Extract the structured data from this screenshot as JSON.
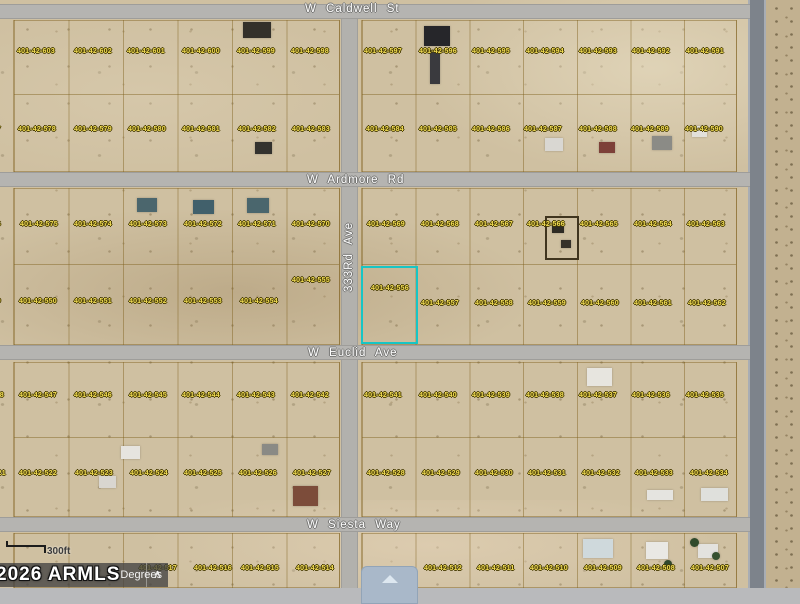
{
  "map": {
    "streets": {
      "caldwell": "W Caldwell St",
      "ardmore": "W Ardmore Rd",
      "euclid": "W Euclid Ave",
      "siesta": "W Siesta Way",
      "ave333": "333Rd Ave"
    },
    "highlight": {
      "parcel": "401-42-556",
      "color": "#17c5c5"
    },
    "plat_note": {
      "line1": "PHOEN",
      "line2": "VALLEY W",
      "line3": "MCR: 13"
    },
    "scale": {
      "label": "300ft"
    },
    "toolbar": {
      "degrees_label": "Degrees",
      "collapse_glyph": "∧"
    },
    "watermark": "2026 ARMLS",
    "label_color": "#f2dd55",
    "parcel_labels": [
      [
        "401-42-603",
        17,
        48
      ],
      [
        "401-42-602",
        74,
        48
      ],
      [
        "401-42-601",
        127,
        48
      ],
      [
        "401-42-600",
        182,
        48
      ],
      [
        "401-42-599",
        237,
        48
      ],
      [
        "401-42-598",
        291,
        48
      ],
      [
        "401-42-597",
        364,
        48
      ],
      [
        "401-42-596",
        419,
        48
      ],
      [
        "401-42-595",
        472,
        48
      ],
      [
        "401-42-594",
        526,
        48
      ],
      [
        "401-42-593",
        579,
        48
      ],
      [
        "401-42-592",
        632,
        48
      ],
      [
        "401-42-591",
        686,
        48
      ],
      [
        "401-42-577",
        -37,
        126
      ],
      [
        "401-42-578",
        18,
        126
      ],
      [
        "401-42-579",
        74,
        126
      ],
      [
        "401-42-580",
        128,
        126
      ],
      [
        "401-42-581",
        182,
        126
      ],
      [
        "401-42-582",
        238,
        126
      ],
      [
        "401-42-583",
        292,
        126
      ],
      [
        "401-42-584",
        366,
        126
      ],
      [
        "401-42-585",
        419,
        126
      ],
      [
        "401-42-586",
        472,
        126
      ],
      [
        "401-42-587",
        524,
        126
      ],
      [
        "401-42-588",
        579,
        126
      ],
      [
        "401-42-589",
        631,
        126
      ],
      [
        "401-42-590",
        685,
        126
      ],
      [
        "401-42-576",
        -37,
        221
      ],
      [
        "401-42-575",
        20,
        221
      ],
      [
        "401-42-574",
        74,
        221
      ],
      [
        "401-42-573",
        129,
        221
      ],
      [
        "401-42-572",
        184,
        221
      ],
      [
        "401-42-571",
        238,
        221
      ],
      [
        "401-42-570",
        292,
        221
      ],
      [
        "401-42-569",
        367,
        221
      ],
      [
        "401-42-568",
        421,
        221
      ],
      [
        "401-42-567",
        475,
        221
      ],
      [
        "401-42-566",
        527,
        221
      ],
      [
        "401-42-565",
        580,
        221
      ],
      [
        "401-42-564",
        634,
        221
      ],
      [
        "401-42-563",
        687,
        221
      ],
      [
        "401-42-549",
        -37,
        298
      ],
      [
        "401-42-550",
        19,
        298
      ],
      [
        "401-42-551",
        74,
        298
      ],
      [
        "401-42-552",
        129,
        298
      ],
      [
        "401-42-553",
        184,
        298
      ],
      [
        "401-42-554",
        240,
        298
      ],
      [
        "401-42-555",
        292,
        277
      ],
      [
        "401-42-557",
        421,
        300
      ],
      [
        "401-42-558",
        475,
        300
      ],
      [
        "401-42-559",
        528,
        300
      ],
      [
        "401-42-560",
        581,
        300
      ],
      [
        "401-42-561",
        634,
        300
      ],
      [
        "401-42-562",
        688,
        300
      ],
      [
        "401-42-548",
        -34,
        392
      ],
      [
        "401-42-547",
        19,
        392
      ],
      [
        "401-42-546",
        74,
        392
      ],
      [
        "401-42-545",
        129,
        392
      ],
      [
        "401-42-544",
        182,
        392
      ],
      [
        "401-42-543",
        237,
        392
      ],
      [
        "401-42-542",
        291,
        392
      ],
      [
        "401-42-541",
        364,
        392
      ],
      [
        "401-42-540",
        419,
        392
      ],
      [
        "401-42-539",
        472,
        392
      ],
      [
        "401-42-538",
        526,
        392
      ],
      [
        "401-42-537",
        579,
        392
      ],
      [
        "401-42-536",
        632,
        392
      ],
      [
        "401-42-535",
        686,
        392
      ],
      [
        "401-42-521",
        -32,
        470
      ],
      [
        "401-42-522",
        19,
        470
      ],
      [
        "401-42-523",
        75,
        470
      ],
      [
        "401-42-524",
        130,
        470
      ],
      [
        "401-42-525",
        184,
        470
      ],
      [
        "401-42-526",
        239,
        470
      ],
      [
        "401-42-527",
        293,
        470
      ],
      [
        "401-42-528",
        367,
        470
      ],
      [
        "401-42-529",
        422,
        470
      ],
      [
        "401-42-530",
        475,
        470
      ],
      [
        "401-42-531",
        528,
        470
      ],
      [
        "401-42-532",
        582,
        470
      ],
      [
        "401-42-533",
        635,
        470
      ],
      [
        "401-42-534",
        690,
        470
      ],
      [
        "401-42-517",
        139,
        565
      ],
      [
        "401-42-516",
        194,
        565
      ],
      [
        "401-42-515",
        241,
        565
      ],
      [
        "401-42-514",
        296,
        565
      ],
      [
        "401-42-512",
        424,
        565
      ],
      [
        "401-42-511",
        477,
        565
      ],
      [
        "401-42-510",
        530,
        565
      ],
      [
        "401-42-509",
        584,
        565
      ],
      [
        "401-42-508",
        637,
        565
      ],
      [
        "401-42-507",
        691,
        565
      ]
    ],
    "highlight_label": {
      "text": "401-42-556",
      "x": 371,
      "y": 285
    },
    "buildings": [
      {
        "x": 243,
        "y": 22,
        "w": 28,
        "h": 16,
        "c": "#33302a"
      },
      {
        "x": 424,
        "y": 26,
        "w": 26,
        "h": 20,
        "c": "#26262a"
      },
      {
        "x": 430,
        "y": 50,
        "w": 10,
        "h": 34,
        "c": "#3a3a3e"
      },
      {
        "x": 255,
        "y": 142,
        "w": 17,
        "h": 12,
        "c": "#33322e"
      },
      {
        "x": 545,
        "y": 138,
        "w": 18,
        "h": 13,
        "c": "#d9d7d2"
      },
      {
        "x": 599,
        "y": 142,
        "w": 16,
        "h": 11,
        "c": "#7d4038"
      },
      {
        "x": 652,
        "y": 136,
        "w": 20,
        "h": 14,
        "c": "#8b8b86"
      },
      {
        "x": 692,
        "y": 126,
        "w": 15,
        "h": 11,
        "c": "#e2e0da"
      },
      {
        "x": 137,
        "y": 198,
        "w": 20,
        "h": 14,
        "c": "#4b666d"
      },
      {
        "x": 193,
        "y": 200,
        "w": 21,
        "h": 14,
        "c": "#41606b"
      },
      {
        "x": 247,
        "y": 198,
        "w": 22,
        "h": 15,
        "c": "#4a666d"
      },
      {
        "x": 545,
        "y": 216,
        "w": 34,
        "h": 44,
        "o": "#40351f"
      },
      {
        "x": 552,
        "y": 224,
        "w": 12,
        "h": 9,
        "c": "#2e2b24"
      },
      {
        "x": 561,
        "y": 240,
        "w": 10,
        "h": 8,
        "c": "#35312a"
      },
      {
        "x": 587,
        "y": 368,
        "w": 25,
        "h": 18,
        "c": "#e7e5df"
      },
      {
        "x": 121,
        "y": 446,
        "w": 19,
        "h": 13,
        "c": "#e6e4df"
      },
      {
        "x": 99,
        "y": 476,
        "w": 17,
        "h": 12,
        "c": "#d9d6d0"
      },
      {
        "x": 262,
        "y": 444,
        "w": 16,
        "h": 11,
        "c": "#8a8a85"
      },
      {
        "x": 293,
        "y": 486,
        "w": 25,
        "h": 20,
        "c": "#7c4c3a"
      },
      {
        "x": 647,
        "y": 490,
        "w": 26,
        "h": 10,
        "c": "#e5e4e0"
      },
      {
        "x": 701,
        "y": 488,
        "w": 27,
        "h": 13,
        "c": "#dfe0dc"
      },
      {
        "x": 583,
        "y": 539,
        "w": 30,
        "h": 19,
        "c": "#cfd9dc"
      },
      {
        "x": 646,
        "y": 542,
        "w": 22,
        "h": 17,
        "c": "#e9e8e4"
      },
      {
        "x": 698,
        "y": 544,
        "w": 20,
        "h": 14,
        "c": "#e3e2de"
      },
      {
        "x": 690,
        "y": 538,
        "w": 9,
        "h": 9,
        "c": "#2f4a2c",
        "rd": 1
      },
      {
        "x": 712,
        "y": 552,
        "w": 8,
        "h": 8,
        "c": "#35502f",
        "rd": 1
      },
      {
        "x": 664,
        "y": 560,
        "w": 8,
        "h": 8,
        "c": "#31482c",
        "rd": 1
      }
    ]
  }
}
